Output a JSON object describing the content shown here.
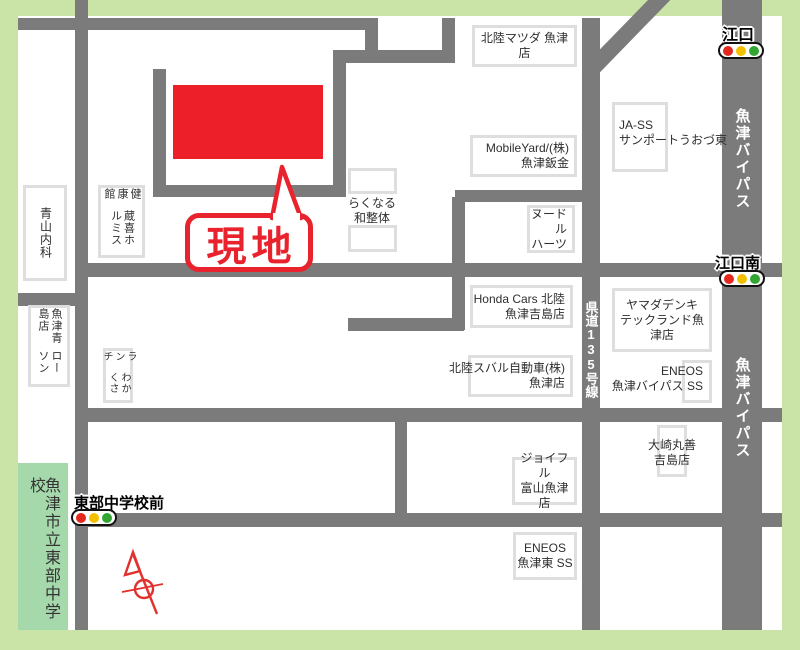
{
  "site": {
    "label": "現地"
  },
  "labels": {
    "aoyama": {
      "col1": "青山内科"
    },
    "kurayoshi": {
      "col1": "蔵喜ホルミス",
      "col2": "健康館"
    },
    "lawson": {
      "col1": "ローソン",
      "col2": "魚津青島店"
    },
    "wakakusa": {
      "col1": "わかくさ",
      "col2": "ランチ"
    },
    "school": {
      "col1": "魚津市立東部中学校"
    },
    "rakunaru": {
      "line1": "らくなる",
      "line2": "和整体"
    },
    "matsuda": {
      "line1": "北陸マツダ 魚津店"
    },
    "mobileyard": {
      "line1": "MobileYard/(株)",
      "line2": "魚津鈑金"
    },
    "jass": {
      "line1": "JA-SS",
      "line2": "サンポートうおづ東"
    },
    "noodle": {
      "line1": "ヌードル",
      "line2": "ハーツ"
    },
    "honda": {
      "line1": "Honda Cars 北陸",
      "line2": "魚津吉島店"
    },
    "yamada": {
      "line1": "ヤマダデンキ",
      "line2": "テックランド魚津店"
    },
    "eneos_bypass": {
      "line1": "ENEOS",
      "line2": "魚津バイパス SS"
    },
    "subaru": {
      "line1": "北陸スバル自動車(株)",
      "line2": "魚津店"
    },
    "osaki": {
      "line1": "大崎丸善",
      "line2": "吉島店"
    },
    "joyfull": {
      "line1": "ジョイフル",
      "line2": "富山魚津店"
    },
    "eneos_east": {
      "line1": "ENEOS",
      "line2": "魚津東 SS"
    }
  },
  "road_names": {
    "kendo": "県道135号線",
    "bypass_upper": "魚津バイパス",
    "bypass_lower": "魚津バイパス"
  },
  "signals": {
    "eguchi": "江口",
    "eguchi_minami": "江口南",
    "tobu_chugakko_mae": "東部中学校前"
  },
  "colors": {
    "border_green": "#c9e4a6",
    "school_green": "#a5d8ab",
    "road_gray": "#7b7b7b",
    "site_red": "#ed2029",
    "callout_red": "#e8232d",
    "signal_red": "#e3281e",
    "signal_yellow": "#f3c000",
    "signal_green": "#33a532",
    "compass_red": "#e0312e"
  }
}
